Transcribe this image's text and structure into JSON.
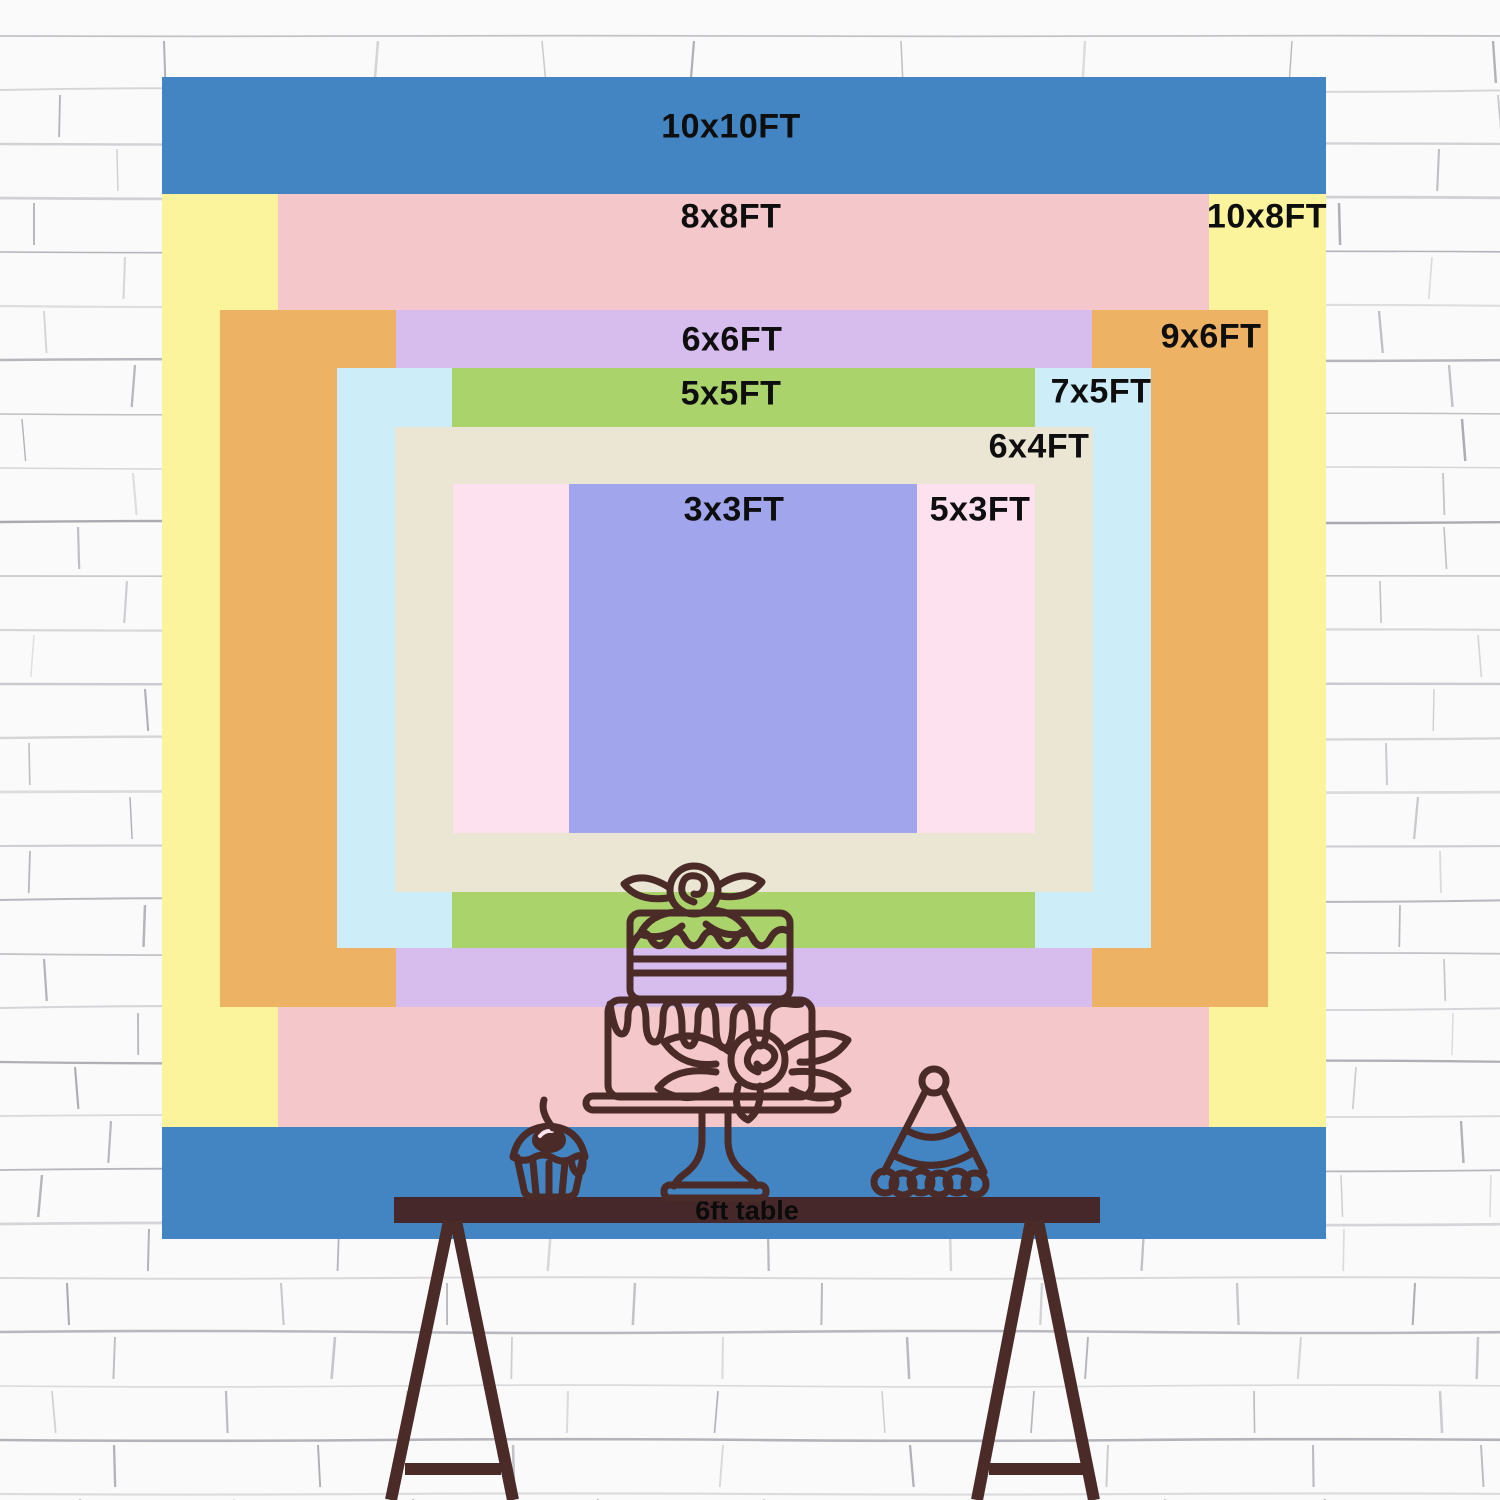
{
  "backdrop": {
    "sizes": [
      {
        "label": "10x10FT",
        "color": "#4285c2"
      },
      {
        "label": "10x8FT",
        "color": "#fcf49c"
      },
      {
        "label": "8x8FT",
        "color": "#f4c8ca"
      },
      {
        "label": "9x6FT",
        "color": "#edb264"
      },
      {
        "label": "6x6FT",
        "color": "#d7bcee"
      },
      {
        "label": "7x5FT",
        "color": "#cdeef9"
      },
      {
        "label": "5x5FT",
        "color": "#abd36b"
      },
      {
        "label": "6x4FT",
        "color": "#ebe6d4"
      },
      {
        "label": "5x3FT",
        "color": "#fde1ef"
      },
      {
        "label": "3x3FT",
        "color": "#a1a5ec"
      }
    ]
  },
  "table": {
    "label": "6ft table",
    "color": "#46282a"
  },
  "decor": {
    "items": [
      "tiered-cake",
      "cupcake",
      "party-hat",
      "easel-legs",
      "brick-wall"
    ]
  },
  "theme": {
    "ink": "#4a2b28",
    "label_color": "#0e0e0e",
    "wall_line": "#8e8e98"
  }
}
